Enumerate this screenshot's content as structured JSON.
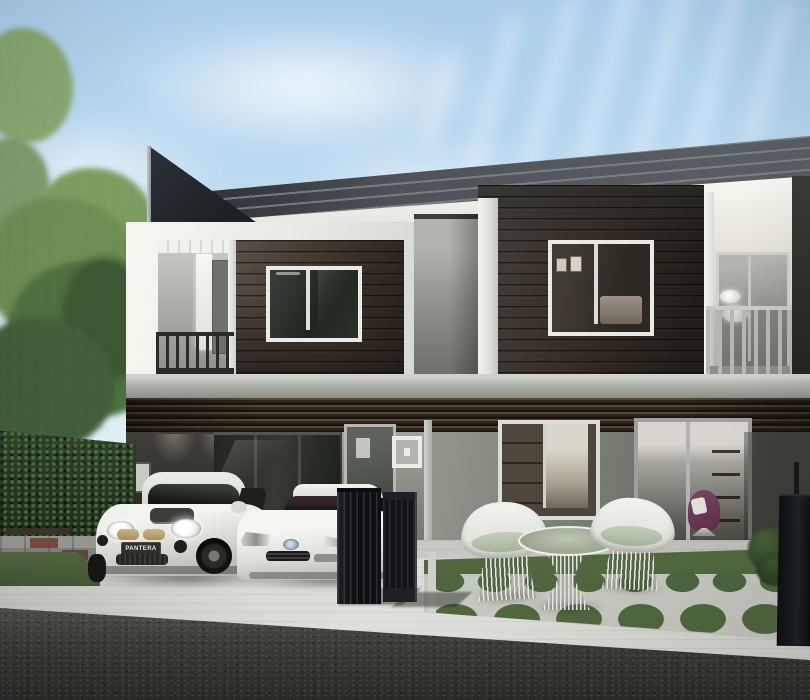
{
  "scene": {
    "title": "Modern two-storey townhome exterior — daytime architectural rendering",
    "sky": "clear blue sky with wispy white clouds",
    "landscaping": [
      "mature leafy tree at left",
      "tall clipped hedge wall",
      "paver stepping stones with wooden bench",
      "lawn strip",
      "patio lawn with circular grass-and-concrete pattern",
      "small clipped shrub at right"
    ]
  },
  "building": {
    "storeys": 2,
    "units_visible": 2,
    "features": [
      "angled black roof fin",
      "charcoal standing-seam roof with white fascia",
      "white box frames",
      "dark timber-clad upper walls",
      "upper-floor sliding windows",
      "recessed balconies with railings",
      "timber louvre band between floors",
      "grey rendered ground floor",
      "full-height glazing with interiors visible",
      "recessed carport",
      "dark metal slat gate",
      "purple armchair visible through glass door"
    ]
  },
  "vehicles": [
    {
      "name": "white mini hatchback",
      "plate_text": "PANTERA"
    },
    {
      "name": "white mazda sports coupe",
      "plate_text": ""
    }
  ],
  "furniture": {
    "items": [
      "white wire lounge chair",
      "round wire coffee table with glass top",
      "white wire lounge chair"
    ],
    "cushion_color": "#b7c4b0"
  },
  "palette": {
    "sky_top": "#a9cdea",
    "sky_horizon": "#eaf3f8",
    "roof": "#4b4f53",
    "roof_fin": "#23282e",
    "white_trim": "#f4f4f0",
    "timber_siding": "#3a332b",
    "timber_dark": "#241f19",
    "wall_grey": "#82837b",
    "carport_shadow": "#302f2b",
    "hedge_green": "#243321",
    "tree_green": "#6e9055",
    "grass_green": "#51683f",
    "patio_concrete": "#c6c7bf",
    "driveway": "#d8d9d5",
    "road_asphalt": "#3b3c37",
    "railing_dark": "#2b2c29",
    "railing_light": "#b6b7b1",
    "car_white": "#f3f4f0",
    "plate_dark": "#30302e",
    "armchair_purple": "#6b3c57",
    "gate_black": "#131417"
  }
}
